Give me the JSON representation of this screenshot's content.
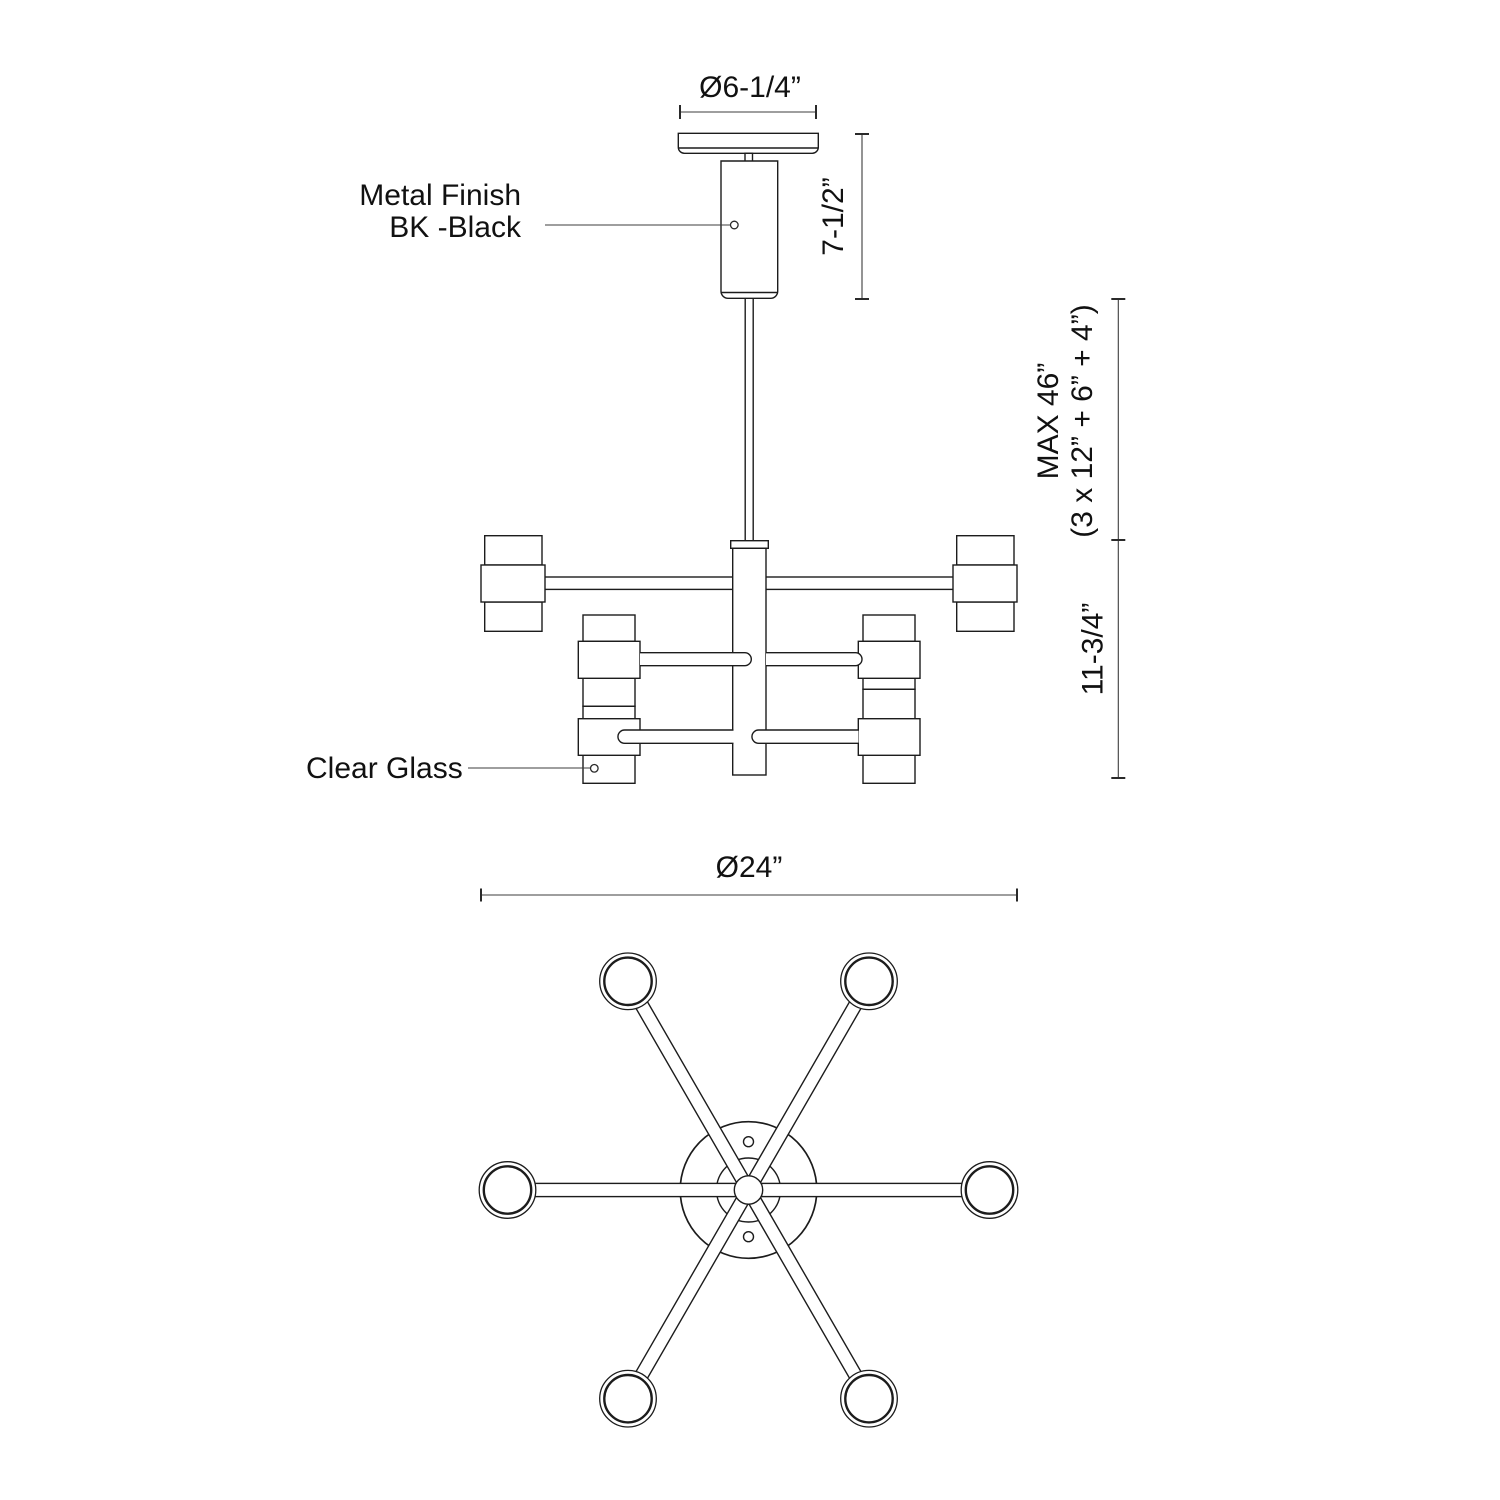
{
  "drawing": {
    "background": "#ffffff",
    "line_color": "#1c1c1c",
    "labels": {
      "metal_finish_line1": "Metal Finish",
      "metal_finish_line2": "BK -Black",
      "clear_glass": "Clear Glass"
    },
    "dimensions": {
      "canopy_diameter": "Ø6-1/4”",
      "canopy_stem_height": "7-1/2”",
      "max_height_line1": "MAX 46”",
      "max_height_line2": "(3 x 12” + 6” + 4”)",
      "body_height": "11-3/4”",
      "fixture_diameter": "Ø24”"
    }
  }
}
